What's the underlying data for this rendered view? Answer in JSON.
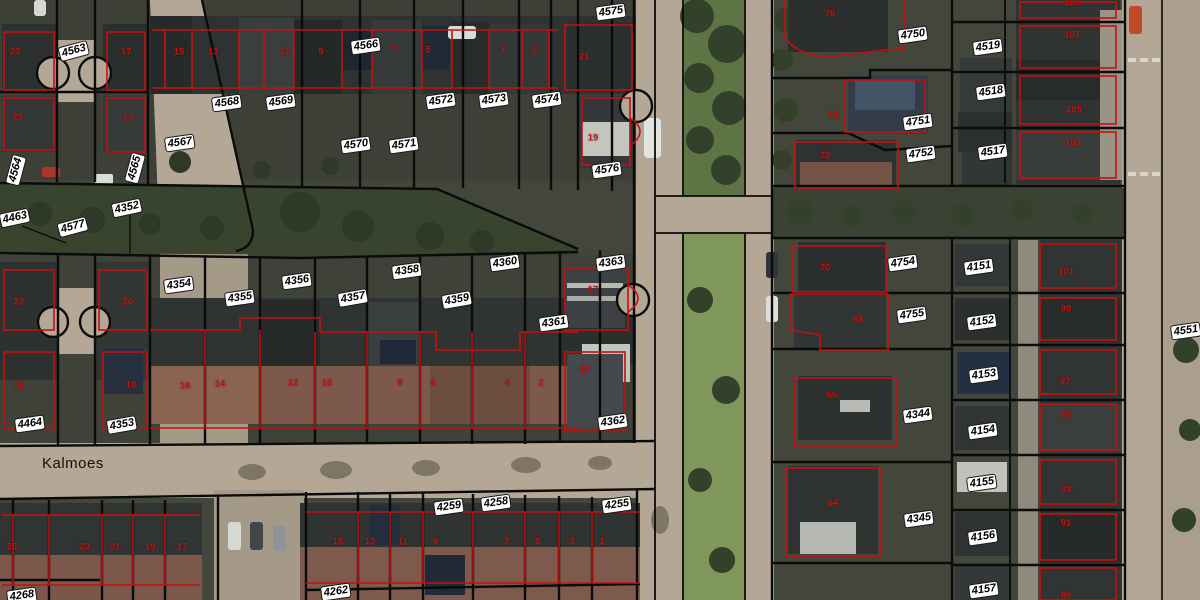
{
  "map": {
    "type": "aerial-cadastral-view",
    "street_label": "Kalmoes",
    "colors": {
      "parcel_boundary": "#0b0b0b",
      "building_outline": "#c31111",
      "house_number": "#c31111",
      "label_bg": "#ffffff",
      "label_text": "#000000",
      "road": "#b4a795",
      "grass_median": "#66804c",
      "garden_block": "#42463b",
      "roof_dark": "#2e3230",
      "roof_brick": "#7c594a"
    },
    "parcel_labels": [
      {
        "text": "4563",
        "x": 74,
        "y": 51,
        "rot": -15
      },
      {
        "text": "4566",
        "x": 366,
        "y": 46,
        "rot": -8
      },
      {
        "text": "4568",
        "x": 227,
        "y": 103,
        "rot": -8
      },
      {
        "text": "4569",
        "x": 281,
        "y": 102,
        "rot": -8
      },
      {
        "text": "4567",
        "x": 180,
        "y": 143,
        "rot": -8
      },
      {
        "text": "4564",
        "x": 16,
        "y": 170,
        "rot": -75
      },
      {
        "text": "4565",
        "x": 135,
        "y": 168,
        "rot": -75
      },
      {
        "text": "4570",
        "x": 356,
        "y": 145,
        "rot": -8
      },
      {
        "text": "4571",
        "x": 404,
        "y": 145,
        "rot": -8
      },
      {
        "text": "4572",
        "x": 441,
        "y": 101,
        "rot": -8
      },
      {
        "text": "4573",
        "x": 494,
        "y": 100,
        "rot": -8
      },
      {
        "text": "4574",
        "x": 547,
        "y": 100,
        "rot": -8
      },
      {
        "text": "4575",
        "x": 611,
        "y": 12,
        "rot": -8
      },
      {
        "text": "4576",
        "x": 607,
        "y": 170,
        "rot": -8
      },
      {
        "text": "4463",
        "x": 15,
        "y": 218,
        "rot": -12
      },
      {
        "text": "4577",
        "x": 73,
        "y": 227,
        "rot": -15
      },
      {
        "text": "4352",
        "x": 127,
        "y": 208,
        "rot": -12
      },
      {
        "text": "4354",
        "x": 179,
        "y": 285,
        "rot": -8
      },
      {
        "text": "4355",
        "x": 240,
        "y": 298,
        "rot": -8
      },
      {
        "text": "4356",
        "x": 297,
        "y": 281,
        "rot": -8
      },
      {
        "text": "4357",
        "x": 353,
        "y": 298,
        "rot": -10
      },
      {
        "text": "4358",
        "x": 407,
        "y": 271,
        "rot": -8
      },
      {
        "text": "4359",
        "x": 457,
        "y": 300,
        "rot": -10
      },
      {
        "text": "4360",
        "x": 505,
        "y": 263,
        "rot": -8
      },
      {
        "text": "4363",
        "x": 611,
        "y": 263,
        "rot": -8
      },
      {
        "text": "4361",
        "x": 554,
        "y": 323,
        "rot": -8
      },
      {
        "text": "4362",
        "x": 613,
        "y": 422,
        "rot": -8
      },
      {
        "text": "4464",
        "x": 30,
        "y": 424,
        "rot": -8
      },
      {
        "text": "4353",
        "x": 122,
        "y": 425,
        "rot": -10
      },
      {
        "text": "4268",
        "x": 22,
        "y": 596,
        "rot": -8
      },
      {
        "text": "4262",
        "x": 336,
        "y": 592,
        "rot": -8
      },
      {
        "text": "4259",
        "x": 449,
        "y": 507,
        "rot": -8
      },
      {
        "text": "4258",
        "x": 496,
        "y": 503,
        "rot": -8
      },
      {
        "text": "4255",
        "x": 617,
        "y": 505,
        "rot": -8
      },
      {
        "text": "4750",
        "x": 913,
        "y": 35,
        "rot": -8
      },
      {
        "text": "4519",
        "x": 988,
        "y": 47,
        "rot": -8
      },
      {
        "text": "4518",
        "x": 991,
        "y": 92,
        "rot": -8
      },
      {
        "text": "4751",
        "x": 918,
        "y": 122,
        "rot": -8
      },
      {
        "text": "4752",
        "x": 921,
        "y": 154,
        "rot": -8
      },
      {
        "text": "4517",
        "x": 993,
        "y": 152,
        "rot": -8
      },
      {
        "text": "4754",
        "x": 903,
        "y": 263,
        "rot": -8
      },
      {
        "text": "4151",
        "x": 979,
        "y": 267,
        "rot": -8
      },
      {
        "text": "4755",
        "x": 912,
        "y": 315,
        "rot": -8
      },
      {
        "text": "4152",
        "x": 982,
        "y": 322,
        "rot": -8
      },
      {
        "text": "4153",
        "x": 984,
        "y": 375,
        "rot": -8
      },
      {
        "text": "4344",
        "x": 918,
        "y": 415,
        "rot": -8
      },
      {
        "text": "4154",
        "x": 983,
        "y": 431,
        "rot": -8
      },
      {
        "text": "4155",
        "x": 982,
        "y": 483,
        "rot": -8
      },
      {
        "text": "4345",
        "x": 919,
        "y": 519,
        "rot": -8
      },
      {
        "text": "4156",
        "x": 983,
        "y": 537,
        "rot": -8
      },
      {
        "text": "4157",
        "x": 984,
        "y": 590,
        "rot": -8
      },
      {
        "text": "4551",
        "x": 1186,
        "y": 331,
        "rot": -8
      }
    ],
    "house_numbers": [
      {
        "text": "23",
        "x": 15,
        "y": 52
      },
      {
        "text": "17",
        "x": 126,
        "y": 52
      },
      {
        "text": "15",
        "x": 179,
        "y": 52
      },
      {
        "text": "13",
        "x": 213,
        "y": 52
      },
      {
        "text": "11",
        "x": 285,
        "y": 52
      },
      {
        "text": "9",
        "x": 321,
        "y": 52
      },
      {
        "text": "7",
        "x": 394,
        "y": 50
      },
      {
        "text": "5",
        "x": 428,
        "y": 50
      },
      {
        "text": "3",
        "x": 502,
        "y": 50
      },
      {
        "text": "1",
        "x": 534,
        "y": 50
      },
      {
        "text": "21",
        "x": 584,
        "y": 57
      },
      {
        "text": "19",
        "x": 593,
        "y": 138
      },
      {
        "text": "21",
        "x": 18,
        "y": 117
      },
      {
        "text": "19",
        "x": 128,
        "y": 118
      },
      {
        "text": "22",
        "x": 19,
        "y": 302
      },
      {
        "text": "20",
        "x": 128,
        "y": 302
      },
      {
        "text": "24",
        "x": 19,
        "y": 386
      },
      {
        "text": "18",
        "x": 131,
        "y": 385
      },
      {
        "text": "16",
        "x": 185,
        "y": 386
      },
      {
        "text": "14",
        "x": 220,
        "y": 384
      },
      {
        "text": "12",
        "x": 293,
        "y": 383
      },
      {
        "text": "10",
        "x": 327,
        "y": 383
      },
      {
        "text": "8",
        "x": 400,
        "y": 383
      },
      {
        "text": "6",
        "x": 433,
        "y": 383
      },
      {
        "text": "4",
        "x": 507,
        "y": 383
      },
      {
        "text": "2",
        "x": 541,
        "y": 383
      },
      {
        "text": "17",
        "x": 593,
        "y": 290
      },
      {
        "text": "15",
        "x": 585,
        "y": 370
      },
      {
        "text": "25",
        "x": 12,
        "y": 547
      },
      {
        "text": "23",
        "x": 85,
        "y": 547
      },
      {
        "text": "21",
        "x": 115,
        "y": 547
      },
      {
        "text": "19",
        "x": 150,
        "y": 547
      },
      {
        "text": "17",
        "x": 182,
        "y": 547
      },
      {
        "text": "15",
        "x": 338,
        "y": 542
      },
      {
        "text": "13",
        "x": 370,
        "y": 542
      },
      {
        "text": "11",
        "x": 403,
        "y": 542
      },
      {
        "text": "9",
        "x": 435,
        "y": 542
      },
      {
        "text": "7",
        "x": 507,
        "y": 542
      },
      {
        "text": "5",
        "x": 538,
        "y": 542
      },
      {
        "text": "3",
        "x": 572,
        "y": 542
      },
      {
        "text": "1",
        "x": 602,
        "y": 542
      },
      {
        "text": "76",
        "x": 830,
        "y": 14
      },
      {
        "text": "74",
        "x": 833,
        "y": 116
      },
      {
        "text": "72",
        "x": 825,
        "y": 156
      },
      {
        "text": "70",
        "x": 825,
        "y": 268
      },
      {
        "text": "68",
        "x": 858,
        "y": 320
      },
      {
        "text": "66",
        "x": 832,
        "y": 395
      },
      {
        "text": "64",
        "x": 833,
        "y": 503
      },
      {
        "text": "109",
        "x": 1072,
        "y": 3
      },
      {
        "text": "107",
        "x": 1072,
        "y": 35
      },
      {
        "text": "105",
        "x": 1074,
        "y": 110
      },
      {
        "text": "103",
        "x": 1073,
        "y": 143
      },
      {
        "text": "101",
        "x": 1066,
        "y": 272
      },
      {
        "text": "99",
        "x": 1066,
        "y": 309
      },
      {
        "text": "97",
        "x": 1065,
        "y": 382
      },
      {
        "text": "95",
        "x": 1066,
        "y": 416
      },
      {
        "text": "93",
        "x": 1066,
        "y": 490
      },
      {
        "text": "91",
        "x": 1066,
        "y": 523
      },
      {
        "text": "89",
        "x": 1066,
        "y": 596
      }
    ]
  }
}
